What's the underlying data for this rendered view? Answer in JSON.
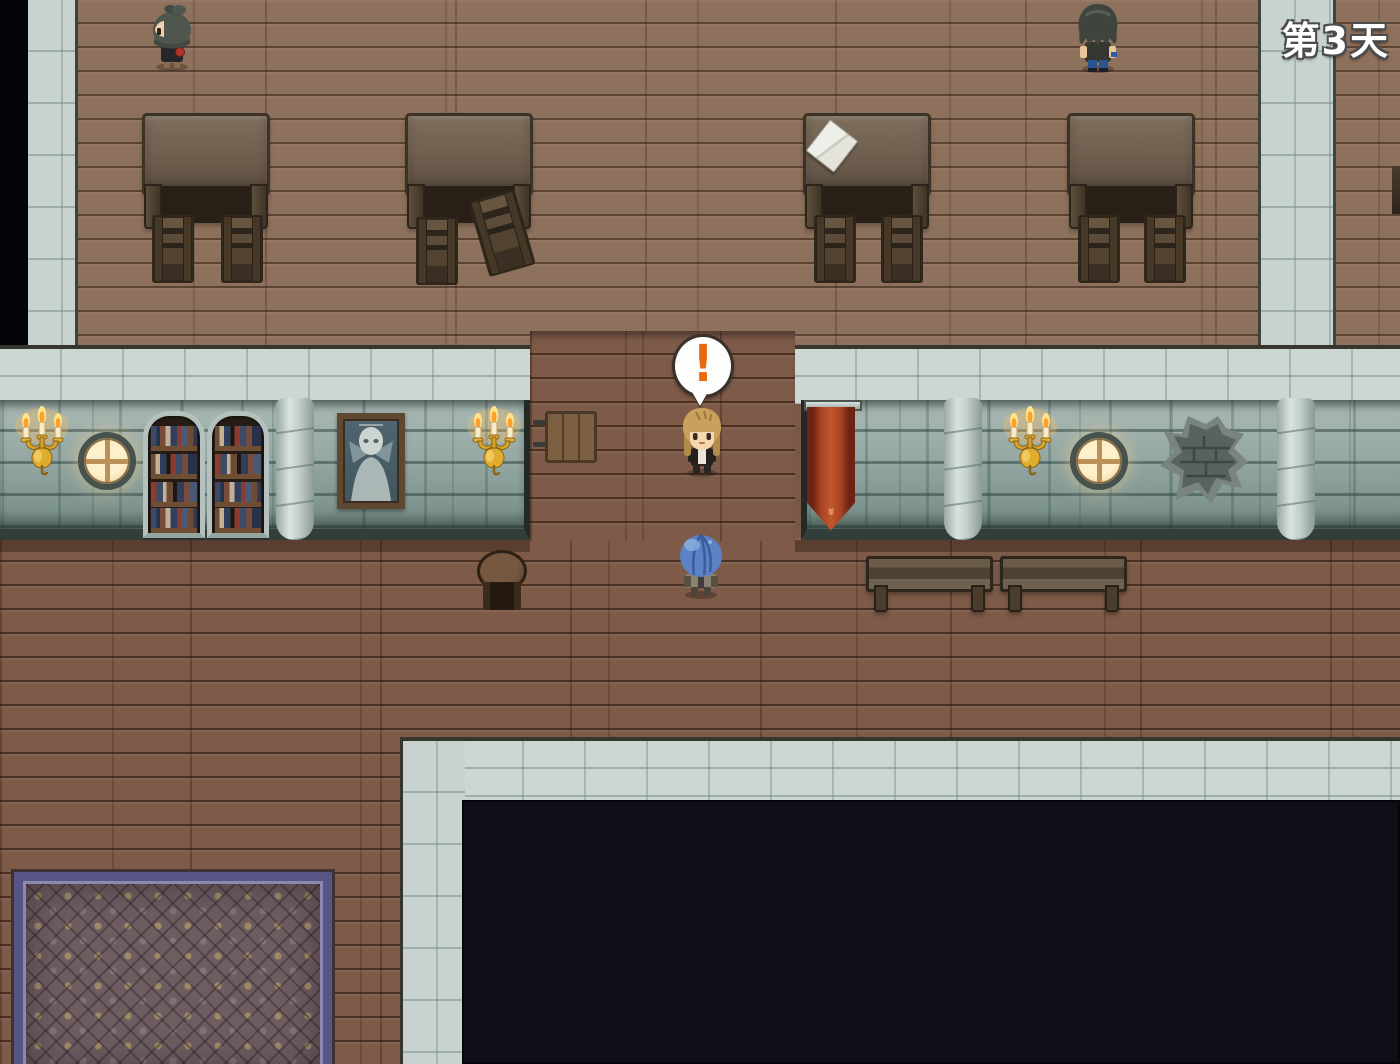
{
  "hud": {
    "day_label": "第3天"
  },
  "balloon": {
    "symbol": "!",
    "color": "#e8690e"
  },
  "palette": {
    "floor_light": "#8e715c",
    "floor_dark": "#7e5b48",
    "wall_brick": "#95a8a3",
    "walkway_tile": "#ccd7d2",
    "pit_black": "#0e0e17",
    "banner_red": "#a84424",
    "candelabra_gold": "#d9a62a",
    "window_glow": "#fdf0cb",
    "carpet_border": "#565585",
    "carpet_field": "#6d5d61"
  },
  "scene": {
    "characters": [
      {
        "name": "npc-ponytail",
        "look": "dark ponytail, facing left, holding red book"
      },
      {
        "name": "npc-shaggy",
        "look": "shaggy dark hair, facing away, blue pants"
      },
      {
        "name": "player",
        "look": "blonde hair, dark jacket, exclamation balloon above"
      },
      {
        "name": "blue-helm-npc",
        "look": "round blue head, facing away"
      }
    ],
    "objects": [
      "desk-tables",
      "chairs",
      "bookshelves",
      "round-windows",
      "candelabras",
      "ghost-painting",
      "red-banner",
      "benches",
      "stool",
      "wood-sign",
      "patterned-carpet",
      "broken-wall-patch",
      "stone-pillars",
      "dark-pit"
    ]
  }
}
